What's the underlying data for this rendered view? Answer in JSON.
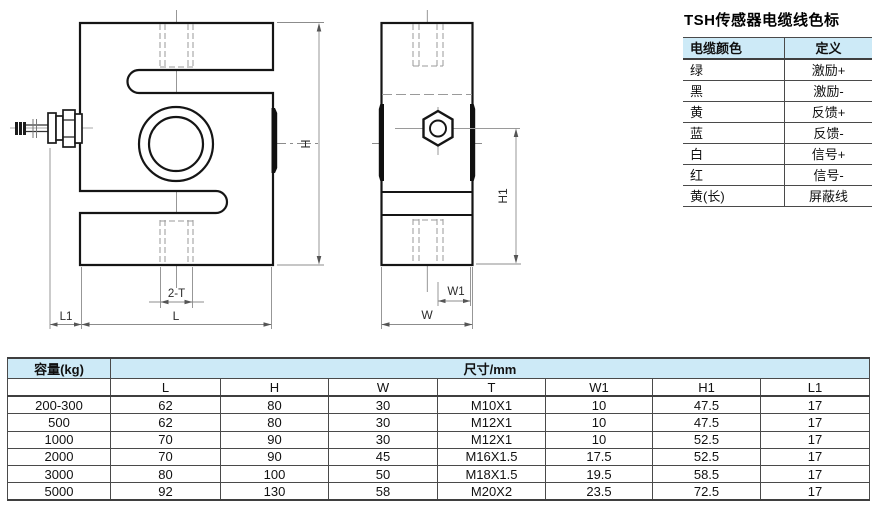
{
  "cable_table": {
    "title": "TSH传感器电缆线色标",
    "headers": [
      "电缆颜色",
      "定义"
    ],
    "rows": [
      [
        "绿",
        "激励+"
      ],
      [
        "黑",
        "激励-"
      ],
      [
        "黄",
        "反馈+"
      ],
      [
        "蓝",
        "反馈-"
      ],
      [
        "白",
        "信号+"
      ],
      [
        "红",
        "信号-"
      ],
      [
        "黄(长)",
        "屏蔽线"
      ]
    ]
  },
  "dim_table": {
    "capacity_header": "容量(kg)",
    "size_header": "尺寸/mm",
    "columns": [
      "L",
      "H",
      "W",
      "T",
      "W1",
      "H1",
      "L1"
    ],
    "rows": [
      {
        "capacity": "200-300",
        "L": "62",
        "H": "80",
        "W": "30",
        "T": "M10X1",
        "W1": "10",
        "H1": "47.5",
        "L1": "17"
      },
      {
        "capacity": "500",
        "L": "62",
        "H": "80",
        "W": "30",
        "T": "M12X1",
        "W1": "10",
        "H1": "47.5",
        "L1": "17"
      },
      {
        "capacity": "1000",
        "L": "70",
        "H": "90",
        "W": "30",
        "T": "M12X1",
        "W1": "10",
        "H1": "52.5",
        "L1": "17"
      },
      {
        "capacity": "2000",
        "L": "70",
        "H": "90",
        "W": "45",
        "T": "M16X1.5",
        "W1": "17.5",
        "H1": "52.5",
        "L1": "17"
      },
      {
        "capacity": "3000",
        "L": "80",
        "H": "100",
        "W": "50",
        "T": "M18X1.5",
        "W1": "19.5",
        "H1": "58.5",
        "L1": "17"
      },
      {
        "capacity": "5000",
        "L": "92",
        "H": "130",
        "W": "58",
        "T": "M20X2",
        "W1": "23.5",
        "H1": "72.5",
        "L1": "17"
      }
    ]
  },
  "drawing": {
    "front_view_labels": {
      "h": "H",
      "l": "L",
      "l1": "L1",
      "t": "2-T"
    },
    "side_view_labels": {
      "h1": "H1",
      "w1": "W1",
      "w": "W"
    }
  },
  "colors": {
    "table_header_blue": "#cdeaf7",
    "table_border": "#4a4a4a",
    "drawing_outline": "#151515",
    "dimension_gray": "#8c8c8c",
    "hidden_line_gray": "#9a9a9a"
  }
}
